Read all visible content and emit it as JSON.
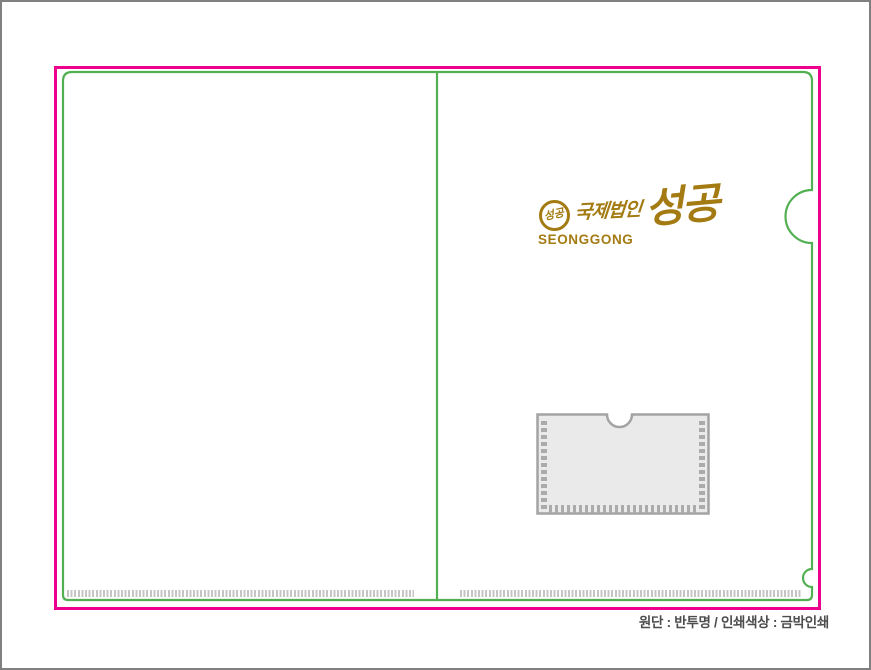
{
  "document": {
    "spec_note": "원단 : 반투명 / 인쇄색상 : 금박인쇄"
  },
  "logo": {
    "emblem_text": "성공",
    "calligraphy_small": "국제법인",
    "calligraphy_large": "성공",
    "brand_roman": "SEONGGONG"
  },
  "colors": {
    "frame_border": "#808080",
    "cut_line": "#EC008C",
    "outline_green": "#52B052",
    "foil_gold": "#A37B12",
    "serration_gray": "#C4C4C4",
    "pocket_border": "#A3A3A3",
    "pocket_fill": "#EAEAEA",
    "pocket_stitch": "#ABABAB",
    "note_text": "#4D4D4D"
  }
}
